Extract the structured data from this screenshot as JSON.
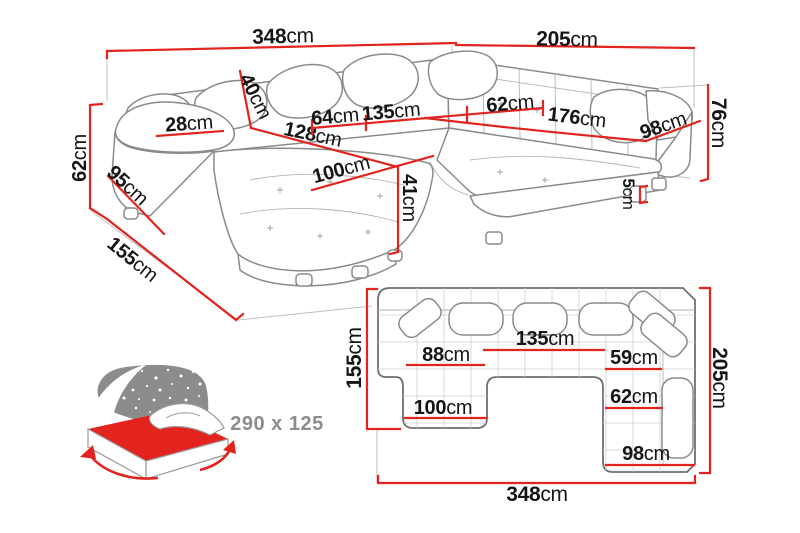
{
  "colors": {
    "dimension_red": "#e2231e",
    "label_black": "#151515",
    "outline_gray": "#8a8a8a",
    "icon_gray": "#8c8c8c"
  },
  "perspective_view": {
    "description": "corner-sofa-3d-sketch",
    "dims": {
      "total_width": {
        "v": "348",
        "u": "cm"
      },
      "right_width": {
        "v": "205",
        "u": "cm"
      },
      "arm_height": {
        "v": "62",
        "u": "cm"
      },
      "back_height": {
        "v": "76",
        "u": "cm"
      },
      "armrest_top_width": {
        "v": "28",
        "u": "cm"
      },
      "backrest_thickness": {
        "v": "40",
        "u": "cm"
      },
      "side_depth": {
        "v": "95",
        "u": "cm"
      },
      "chaise_total_depth": {
        "v": "155",
        "u": "cm"
      },
      "back_seat_left": {
        "v": "64",
        "u": "cm"
      },
      "back_seat_middle": {
        "v": "135",
        "u": "cm"
      },
      "chaise_length": {
        "v": "128",
        "u": "cm"
      },
      "chaise_width": {
        "v": "100",
        "u": "cm"
      },
      "seat_height": {
        "v": "41",
        "u": "cm"
      },
      "corner_seat_width": {
        "v": "62",
        "u": "cm"
      },
      "right_seat_length": {
        "v": "176",
        "u": "cm"
      },
      "right_arm_length": {
        "v": "98",
        "u": "cm"
      },
      "leg_height": {
        "v": "5",
        "u": "cm"
      }
    }
  },
  "plan_view": {
    "description": "corner-sofa-top-plan",
    "dims": {
      "left_depth": {
        "v": "155",
        "u": "cm"
      },
      "chaise_seat_width": {
        "v": "88",
        "u": "cm"
      },
      "middle_seat_width": {
        "v": "135",
        "u": "cm"
      },
      "right_seat_top": {
        "v": "59",
        "u": "cm"
      },
      "chaise_width": {
        "v": "100",
        "u": "cm"
      },
      "right_seat_mid": {
        "v": "62",
        "u": "cm"
      },
      "right_section_width": {
        "v": "98",
        "u": "cm"
      },
      "total_width": {
        "v": "348",
        "u": "cm"
      },
      "right_depth": {
        "v": "205",
        "u": "cm"
      }
    }
  },
  "sleeping_function": {
    "icon": "sofa-bed-sleeping-area-icon",
    "size_label": "290 x 125"
  }
}
